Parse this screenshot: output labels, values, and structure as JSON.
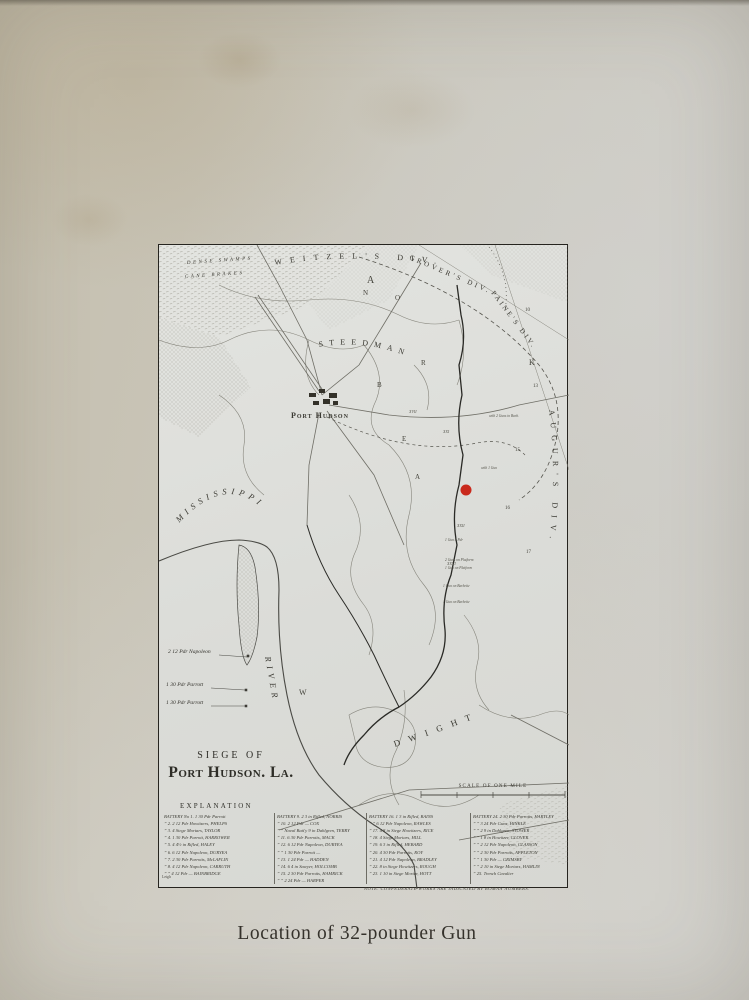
{
  "page": {
    "caption": "Location of 32-pounder Gun"
  },
  "map": {
    "title_line1": "SIEGE OF",
    "title_line2": "Port Hudson. La.",
    "town_label": "Port Hudson",
    "scale_label": "SCALE OF ONE MILE",
    "swamp_label1": "DENSE SWAMPS",
    "swamp_label2": "CANE BRAKES",
    "river_word1": "MISSISSIPPI",
    "river_word2": "RIVER",
    "marker_color": "#c9291c",
    "divisions": {
      "weitzel": "WEITZEL'S DIV.",
      "grover": "GROVER'S DIV.",
      "paine": "PAINE'S DIV.",
      "augur": "AUGUR'S DIV.",
      "steedman": "STEEDMAN",
      "dwight": "DWIGHT"
    },
    "gun_labels": [
      "2 12 Pdr Napoleon",
      "1 30 Pdr Parrott",
      "1 30 Pdr Parrott"
    ],
    "scatter": [
      {
        "t": "A",
        "x": 208,
        "y": 38,
        "s": 10
      },
      {
        "t": "N",
        "x": 204,
        "y": 50,
        "s": 7
      },
      {
        "t": "O",
        "x": 236,
        "y": 55,
        "s": 7
      },
      {
        "t": "R",
        "x": 262,
        "y": 120,
        "s": 7
      },
      {
        "t": "B",
        "x": 218,
        "y": 142,
        "s": 7
      },
      {
        "t": "E",
        "x": 243,
        "y": 196,
        "s": 7
      },
      {
        "t": "A",
        "x": 256,
        "y": 234,
        "s": 7
      },
      {
        "t": "K",
        "x": 370,
        "y": 120,
        "s": 8
      },
      {
        "t": "W",
        "x": 140,
        "y": 450,
        "s": 8
      },
      {
        "t": "10",
        "x": 366,
        "y": 66,
        "s": 5
      },
      {
        "t": "13",
        "x": 374,
        "y": 142,
        "s": 5
      },
      {
        "t": "15",
        "x": 356,
        "y": 206,
        "s": 5
      },
      {
        "t": "16",
        "x": 346,
        "y": 264,
        "s": 5
      },
      {
        "t": "17",
        "x": 367,
        "y": 308,
        "s": 5
      },
      {
        "t": "XXI",
        "x": 284,
        "y": 188,
        "s": 4,
        "i": 1
      },
      {
        "t": "XVII",
        "x": 250,
        "y": 168,
        "s": 4,
        "i": 1
      },
      {
        "t": "XXII",
        "x": 298,
        "y": 282,
        "s": 4,
        "i": 1
      },
      {
        "t": "XXVI",
        "x": 288,
        "y": 320,
        "s": 4,
        "i": 1
      },
      {
        "t": "with 2 Guns in Barb.",
        "x": 330,
        "y": 172,
        "s": 3.6,
        "i": 1
      },
      {
        "t": "with 1 Gun",
        "x": 322,
        "y": 224,
        "s": 3.6,
        "i": 1
      },
      {
        "t": "1 Gun 8 Pdr",
        "x": 286,
        "y": 296,
        "s": 3.6,
        "i": 1
      },
      {
        "t": "2 Guns on Platform",
        "x": 286,
        "y": 316,
        "s": 3.6,
        "i": 1
      },
      {
        "t": "1 Gun on Platform",
        "x": 286,
        "y": 324,
        "s": 3.6,
        "i": 1
      },
      {
        "t": "1 Gun on Barbette",
        "x": 284,
        "y": 342,
        "s": 3.6,
        "i": 1
      },
      {
        "t": "1 Gun on Barbette",
        "x": 284,
        "y": 358,
        "s": 3.6,
        "i": 1
      }
    ],
    "legend": {
      "heading": "EXPLANATION",
      "columns": [
        {
          "rows": [
            "BATTERY No 1. 1 30 Pdr Parrott",
            "” 2. 2 12 Pdr Howitzers, PHELPS",
            "” 3. 4 Siege Mortars, TAYLOR",
            "” 4. 1 30 Pdr Parrott, HARROWER",
            "” 5. 4 4½ in Rifled, HALEY",
            "” 6. 6 12 Pdr Napoleon, DURYEA",
            "” 7. 2 30 Pdr Parrotts, McLAFLIN",
            "” 8. 4 12 Pdr Napoleon, CARRUTH",
            "” ”  4 12 Pdr — BAINBRIDGE"
          ]
        },
        {
          "rows": [
            "BATTERY 9. 2 3 in Rifled, NORRIS",
            "” 10. 2 12 Pdr — COX",
            "” ”  Naval Batt'y 9 in Dahlgren, TERRY",
            "” 11. 6 30 Pdr Parrotts, MACK",
            "” 12. 6 12 Pdr Napoleon, DURYEA",
            "” ”  1 30 Pdr Parrott —",
            "” 13. 1 24 Pdr — HADDEN",
            "” 14. 6 4 in Sawyer, HOLCOMB",
            "” 15. 2 30 Pdr Parrotts, HAMRICK",
            "” ”  2 24 Pdr — HARPER"
          ]
        },
        {
          "rows": [
            "BATTERY 16. 1 3 in Rifled, BAINS",
            "” ”  6 12 Pdr Napoleon, RAWLES",
            "” 17. 4 8 in Siege Howitzers, RICE",
            "” 18. 4 Siege Mortars, HILL",
            "” 19. 6 3 in Rifled, HEBARD",
            "” 20. 4 30 Pdr Parrotts, ROY",
            "” 21. 4 12 Pdr Napoleon, BRADLEY",
            "” 22. 8 in Siege Howitzers, ROUGH",
            "” 23. 1 10 in Siege Mortar, HOTT"
          ]
        },
        {
          "rows": [
            "BATTERY 24. 2 30 Pdr Parrotts, HARTLEY",
            "” ”  3 24 Pdr Guns, HINKLE",
            "” ”  2 9 in Dahlgren, STOWER",
            "” ”  1 8 in Howitzer, GLOVER",
            "” ”  2 12 Pdr Napoleon, GLASSON",
            "” ”  2 30 Pdr Parrotts, APPLETON",
            "” ”  1 30 Pdr — GRIMSBY",
            "” ”  2 10 in Siege Mortars, HAMLIN",
            "” 25. Trench Cavalier"
          ]
        }
      ],
      "note": "NOTE. CONFEDERATE WORKS ARE INDICATED BY ROMAN NUMBERS.",
      "engraver_mark": "Leigh"
    }
  }
}
